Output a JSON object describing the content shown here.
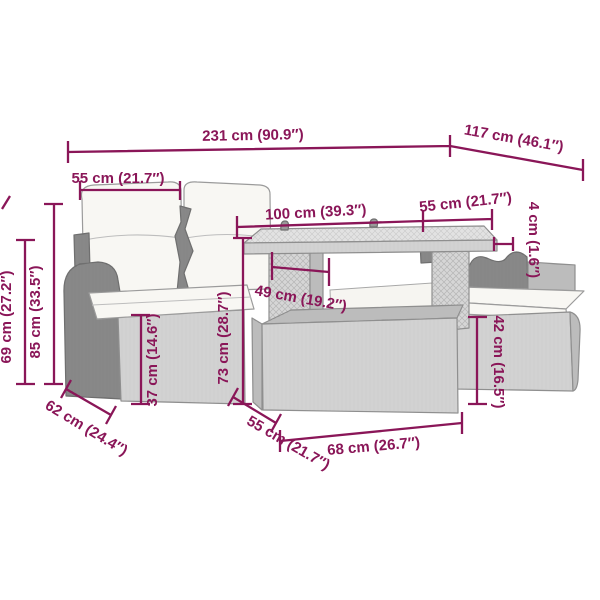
{
  "colors": {
    "dimension": "#8a1658",
    "furniture_outline": "#8f8f8f",
    "wicker_light": "#dbdbdb",
    "wicker_dark": "#939393",
    "cushion": "#f8f7f3",
    "background": "#ffffff"
  },
  "dims": {
    "total_width": "231 cm (90.9″)",
    "total_depth": "117 cm (46.1″)",
    "seat_width": "55 cm (21.7″)",
    "table_length": "100 cm (39.3″)",
    "stool_top_width": "55 cm (21.7″)",
    "tabletop_thickness": "4 cm (1.6″)",
    "armrest_height": "69 cm (27.2″)",
    "backrest_height": "85 cm (33.5″)",
    "seat_height": "37 cm (14.6″)",
    "table_height": "73 cm (28.7″)",
    "table_leg_clearance": "49 cm (19.2″)",
    "sofa_depth": "62 cm (24.4″)",
    "stool_depth": "55 cm (21.7″)",
    "stool_length": "68 cm (26.7″)",
    "stool_height": "42 cm (16.5″)"
  }
}
